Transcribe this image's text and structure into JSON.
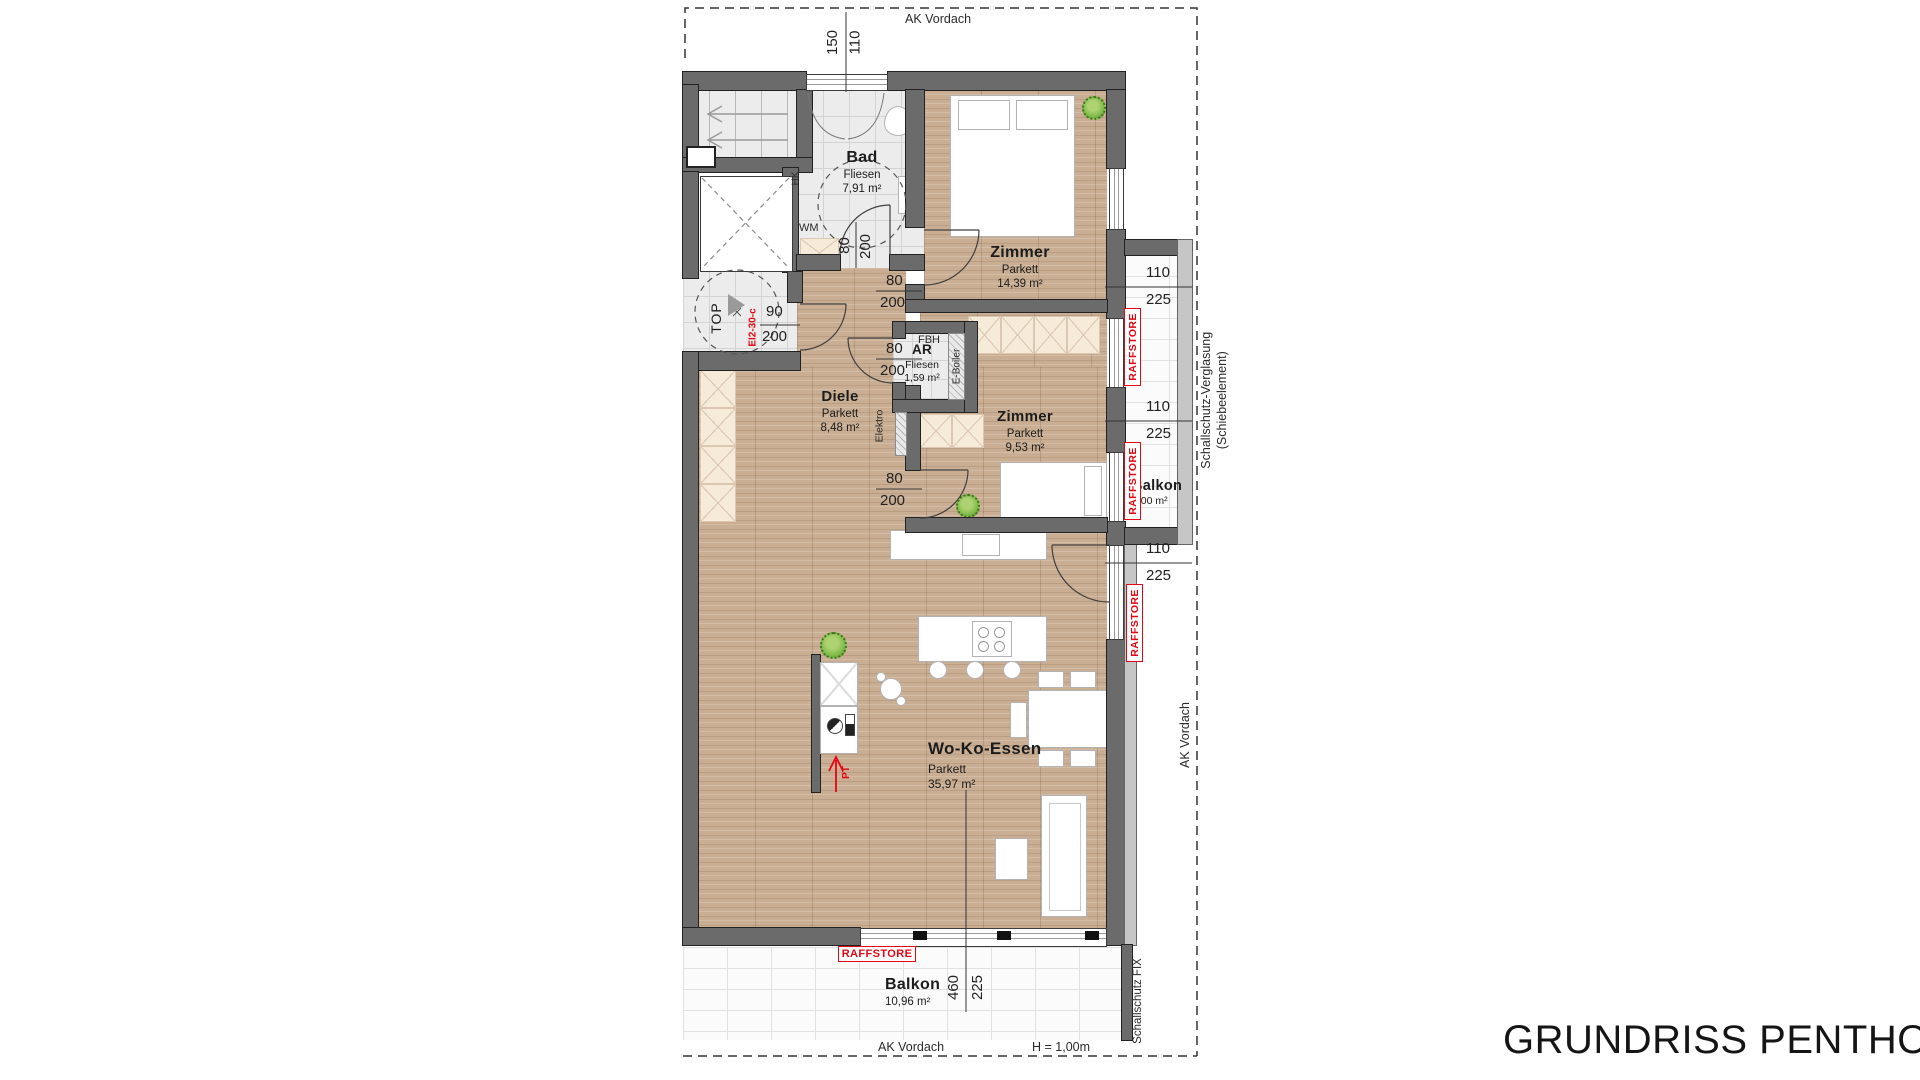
{
  "title": "GRUNDRISS PENTHOUSE",
  "rooms": {
    "bad": {
      "name": "Bad",
      "floor": "Fliesen",
      "area": "7,91 m²"
    },
    "zimmer1": {
      "name": "Zimmer",
      "floor": "Parkett",
      "area": "14,39 m²"
    },
    "diele": {
      "name": "Diele",
      "floor": "Parkett",
      "area": "8,48 m²"
    },
    "ar": {
      "name": "AR",
      "floor": "Fliesen",
      "area": "1,59 m²"
    },
    "zimmer2": {
      "name": "Zimmer",
      "floor": "Parkett",
      "area": "9,53 m²"
    },
    "balkon_ost": {
      "name": "Balkon",
      "area": "6,00 m²"
    },
    "wohnen": {
      "name": "Wo-Ko-Essen",
      "floor": "Parkett",
      "area": "35,97 m²"
    },
    "balkon_sued": {
      "name": "Balkon",
      "area": "10,96 m²"
    }
  },
  "labels": {
    "wm": "WM",
    "hk": "HK",
    "fbh": "FBH",
    "eboiler": "E-Boiler",
    "elektro": "Elektro",
    "top_unit": "TOP",
    "fire_door": "EI2-30-c",
    "pt": "PT",
    "raffstore": "RAFFSTORE",
    "ak_vordach": "AK Vordach",
    "balkon_height": "H = 1,00m",
    "schallschutz_verglasung": "Schallschutz-Verglasung",
    "schiebeelement": "(Schiebeelement)",
    "schallschutz_fix": "Schallschutz FIX"
  },
  "dimensions": {
    "top_window": {
      "a": "150",
      "b": "110"
    },
    "window_1": {
      "a": "110",
      "b": "225"
    },
    "window_2": {
      "a": "110",
      "b": "225"
    },
    "window_3": {
      "a": "110",
      "b": "225"
    },
    "entry_door": {
      "a": "90",
      "b": "200"
    },
    "bad_door": {
      "a": "80",
      "b": "200"
    },
    "zimmer1_door": {
      "a": "80",
      "b": "200"
    },
    "ar_door": {
      "a": "80",
      "b": "200"
    },
    "zimmer2_door": {
      "a": "80",
      "b": "200"
    },
    "balkon_sued": {
      "a": "460",
      "b": "225"
    }
  },
  "colors": {
    "accent_red": "#E30613",
    "wall_gray": "#6B6B6B",
    "tile_gray": "#ECECEC",
    "parquet": "#C9AE93",
    "plant_green": "#7FBB4A"
  }
}
